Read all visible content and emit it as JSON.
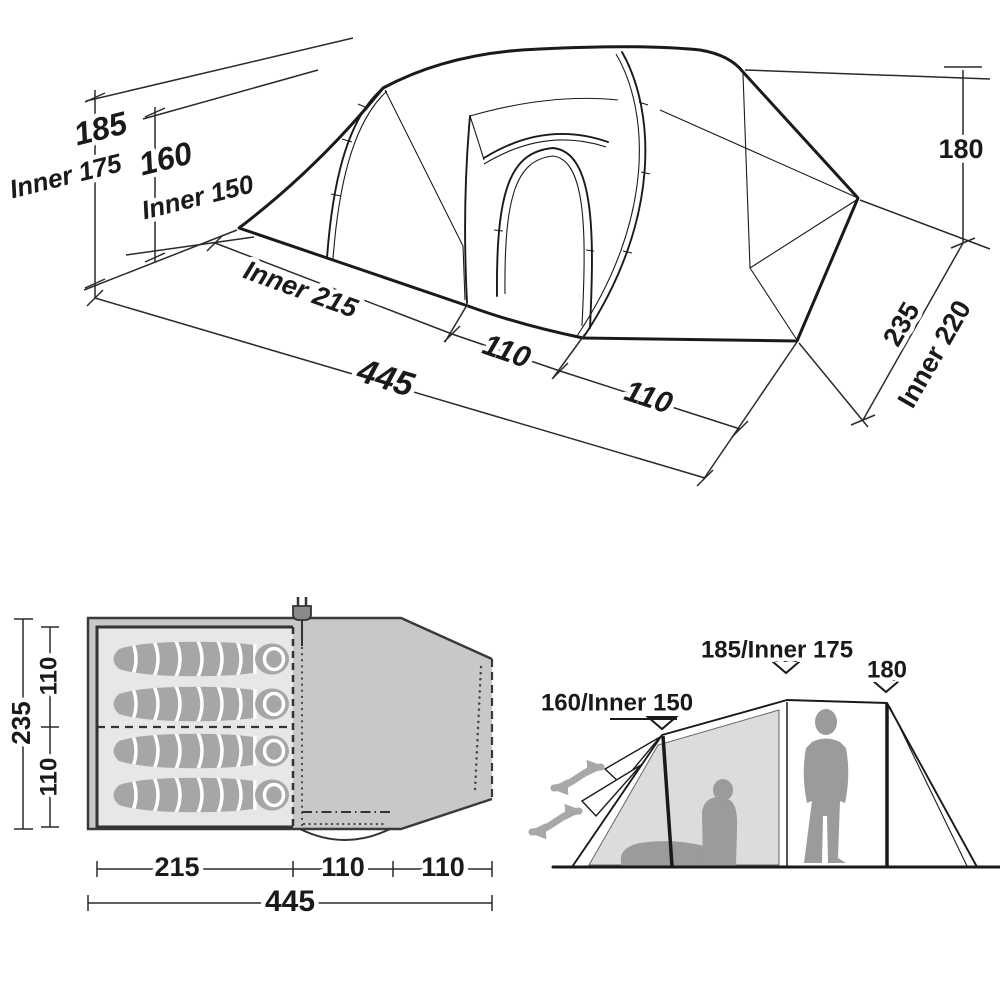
{
  "colors": {
    "line": "#1a1a1a",
    "porch_gray": "#c8c8c8",
    "inner_gray": "#e7e7e7",
    "bag_gray": "#a6a6a6",
    "silhouette_gray": "#9b9b9b",
    "panel_gray": "#dcdcdc",
    "arrow_gray": "#a8a8a8"
  },
  "iso_view": {
    "labels": {
      "height_outer": "185",
      "height_inner": "Inner 175",
      "front_height_outer": "160",
      "front_height_inner": "Inner 150",
      "inner_length": "Inner 215",
      "total_length": "445",
      "mid_section": "110",
      "front_section": "110",
      "rear_height": "180",
      "width_outer": "235",
      "width_inner": "Inner 220"
    }
  },
  "floor_plan": {
    "sleeping_bag_count": 4,
    "labels": {
      "width_total": "235",
      "width_upper": "110",
      "width_lower": "110",
      "inner_length": "215",
      "porch_length": "110",
      "front_length": "110",
      "total_length": "445"
    }
  },
  "side_view": {
    "labels": {
      "front_height": "160/Inner 150",
      "main_height": "185/Inner 175",
      "rear_height": "180"
    }
  }
}
